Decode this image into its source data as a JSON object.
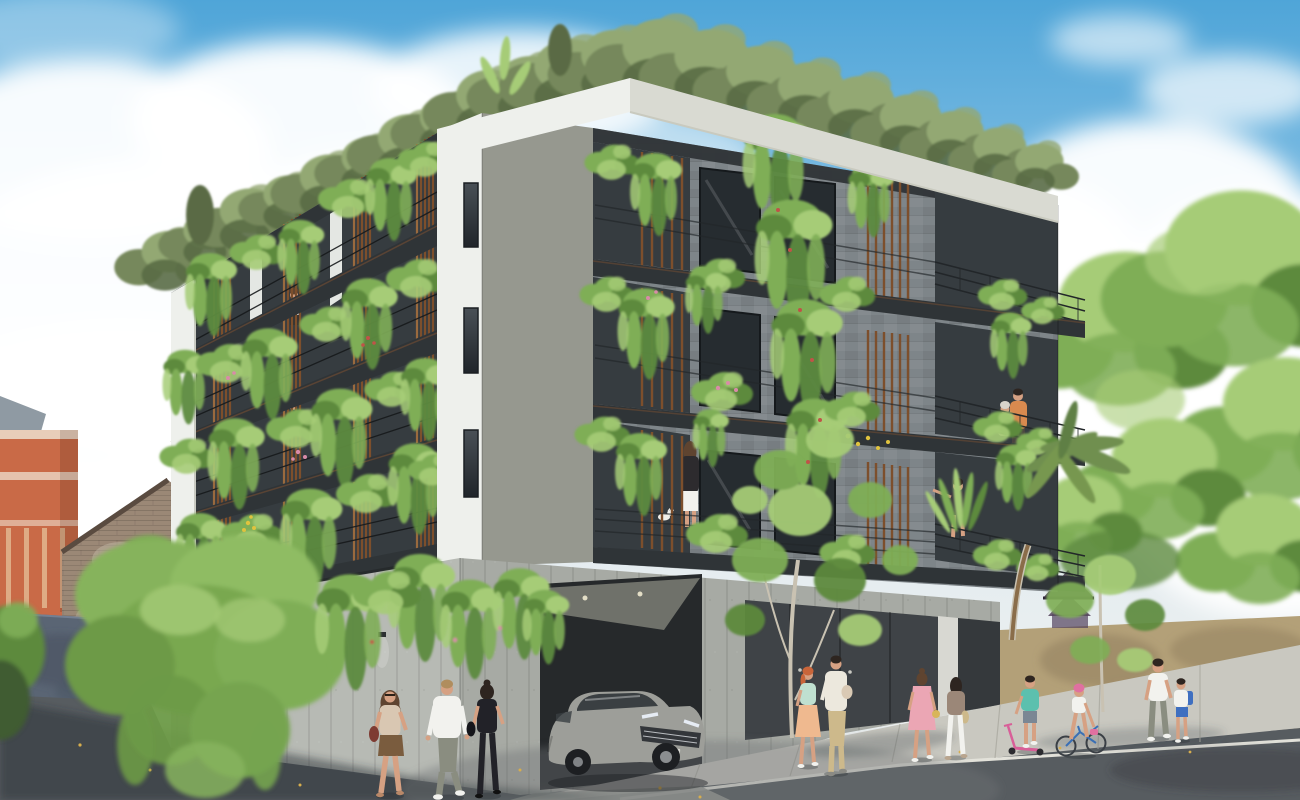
{
  "scene": {
    "type": "exterior architectural rendering",
    "description": "Street-corner daytime view of a modern four-storey eco apartment building with plant-covered balconies, wood slat screens, a rooftop garden, a board-formed concrete podium with a silver SUV exiting the garage, and pedestrians on the street and sidewalk under a partly cloudy blue sky.",
    "sky": {
      "condition": "partly cloudy",
      "clouds": "large white cumulus masses on left and right"
    },
    "palette": {
      "sky_top": "#4fa5d8",
      "sky_mid": "#8cc4e6",
      "sky_low": "#e2ebef",
      "cloud": "#ffffff",
      "building_white": "#eef0ec",
      "parapet_shadow": "#d9dad2",
      "facade_gray": "#8d938c",
      "stone": "#7e8589",
      "void_dark": "#363c40",
      "fascia_dark": "#2f3437",
      "window_dark": "#262c30",
      "wood": "#7d4f2c",
      "wood_light": "#9a6a3e",
      "plant_light": "#a6cc77",
      "plant_mid": "#7fae57",
      "plant_dark": "#5d8a3e",
      "olive": "#76885c",
      "olive_light": "#93a873",
      "olive_dark": "#5a6b45",
      "concrete_light": "#b7bab4",
      "concrete_mid": "#a7aaa4",
      "garage_dark": "#26292b",
      "door_dark": "#3f4347",
      "street": "#575c60",
      "street_shadow": "#2c3238",
      "sidewalk": "#c9c8c0",
      "curb": "#e3e2da",
      "tan_wall": "#b3a078",
      "tan_shadow": "#8f7d5c",
      "brick": "#9b8876",
      "brick_dark": "#6e5c4d",
      "ornate_orange": "#c96a47",
      "ornate_trim": "#e8cdb9",
      "slate": "#8f9aa3",
      "wall_blue": "#5a6574",
      "wall_blue_dark": "#47515f",
      "car_body": "#9d9e99",
      "car_dark": "#33363a",
      "glass": "#3a3f42",
      "skin": "#d6a183",
      "hair_brown": "#5f4430",
      "hair_dark": "#2e2520",
      "hair_blond": "#b08d5e",
      "hair_red": "#c9653a",
      "white_cloth": "#f2f2ee",
      "black_cloth": "#222228",
      "beige": "#d9c7b2",
      "brown_skirt": "#7a5c3e",
      "gray_pants": "#8a8d80",
      "mint": "#bfe0d0",
      "peach_skirt": "#efb98f",
      "khaki": "#cdb98b",
      "pink": "#eba6b4",
      "teal": "#5cc0ae",
      "blue": "#3f6fc0",
      "orange_shirt": "#d98a4f",
      "flower_pink": "#d98ba8",
      "flower_yellow": "#e0c33e",
      "flower_red": "#c05348",
      "trunk": "#c9c2b2",
      "palm_green": "#6f8f4f",
      "purple_roof": "#53415c",
      "bag_red": "#7e3b32"
    },
    "building": {
      "storeys_visible": 4,
      "corner_windows": 3,
      "balconies": "dark steel balconies with thin railings, vertical wood slat screens and cascading planters",
      "rooftop": "roof garden with olive-green trees and banana leaves",
      "base": "board-formed concrete podium with garage opening and dark entrance doors"
    },
    "vehicles": [
      {
        "type": "suv",
        "color": "silver-gray",
        "location": "exiting the corner garage"
      }
    ],
    "people": [
      {
        "id": "pedestrian-woman-beige",
        "description": "woman walking toward viewer",
        "top": "beige",
        "bottom": "brown skirt",
        "accessory": "dark red shoulder bag"
      },
      {
        "id": "pedestrian-man-white-shirt",
        "description": "man walking away",
        "top": "white shirt",
        "bottom": "gray-green trousers"
      },
      {
        "id": "pedestrian-woman-black",
        "description": "woman walking away",
        "top": "black tank",
        "bottom": "black pants"
      },
      {
        "id": "sidewalk-woman-redhead",
        "description": "red-haired woman standing",
        "top": "mint",
        "bottom": "peach skirt"
      },
      {
        "id": "sidewalk-man-khaki",
        "description": "man holding a child",
        "top": "cream knit",
        "bottom": "khaki trousers"
      },
      {
        "id": "sidewalk-woman-pink-dress",
        "description": "woman in pink dress walking away",
        "top": "pink dress",
        "bottom": ""
      },
      {
        "id": "sidewalk-woman-white-pants",
        "description": "woman walking away",
        "top": "brown top",
        "bottom": "white pants"
      },
      {
        "id": "scooter-boy",
        "description": "boy with pink scooter",
        "top": "teal tee",
        "bottom": "blue-gray shorts"
      },
      {
        "id": "cyclist-girl",
        "description": "girl riding bicycle",
        "top": "white top",
        "bottom": "pink helmet"
      },
      {
        "id": "sidewalk-man-white-tee",
        "description": "man walking with boy",
        "top": "white tee",
        "bottom": "gray pants"
      },
      {
        "id": "sidewalk-boy-backpack",
        "description": "boy with blue backpack",
        "top": "white tee",
        "bottom": "blue shorts"
      },
      {
        "id": "balcony-woman-white-skirt",
        "description": "woman on balcony facing away",
        "top": "dark jacket",
        "bottom": "white skirt"
      },
      {
        "id": "balcony-woman-pointing",
        "description": "woman on balcony pointing left",
        "top": "dark top",
        "bottom": ""
      },
      {
        "id": "balcony-couple",
        "description": "couple leaning on right balcony",
        "top": "orange shirt / pale top",
        "bottom": ""
      },
      {
        "id": "balcony-woman-left-facade",
        "description": "small figure on upper left balcony",
        "top": "white",
        "bottom": "dark"
      }
    ],
    "animals": [
      {
        "type": "cat",
        "color": "white",
        "location": "first balcony floor beside planter"
      }
    ],
    "context": {
      "left": [
        "terracotta heritage building with cream cornices",
        "old brick gable house",
        "blue-gray boundary wall with leaf shadows",
        "large cascading green tree"
      ],
      "right": [
        "tan boundary wall",
        "purple tiered-roof structure",
        "mature green trees",
        "palm crown and trunk",
        "young street trees"
      ],
      "street": [
        "dark asphalt road",
        "light concrete sidewalk with joint lines",
        "scattered yellow fallen leaves",
        "tree shadows"
      ]
    }
  }
}
